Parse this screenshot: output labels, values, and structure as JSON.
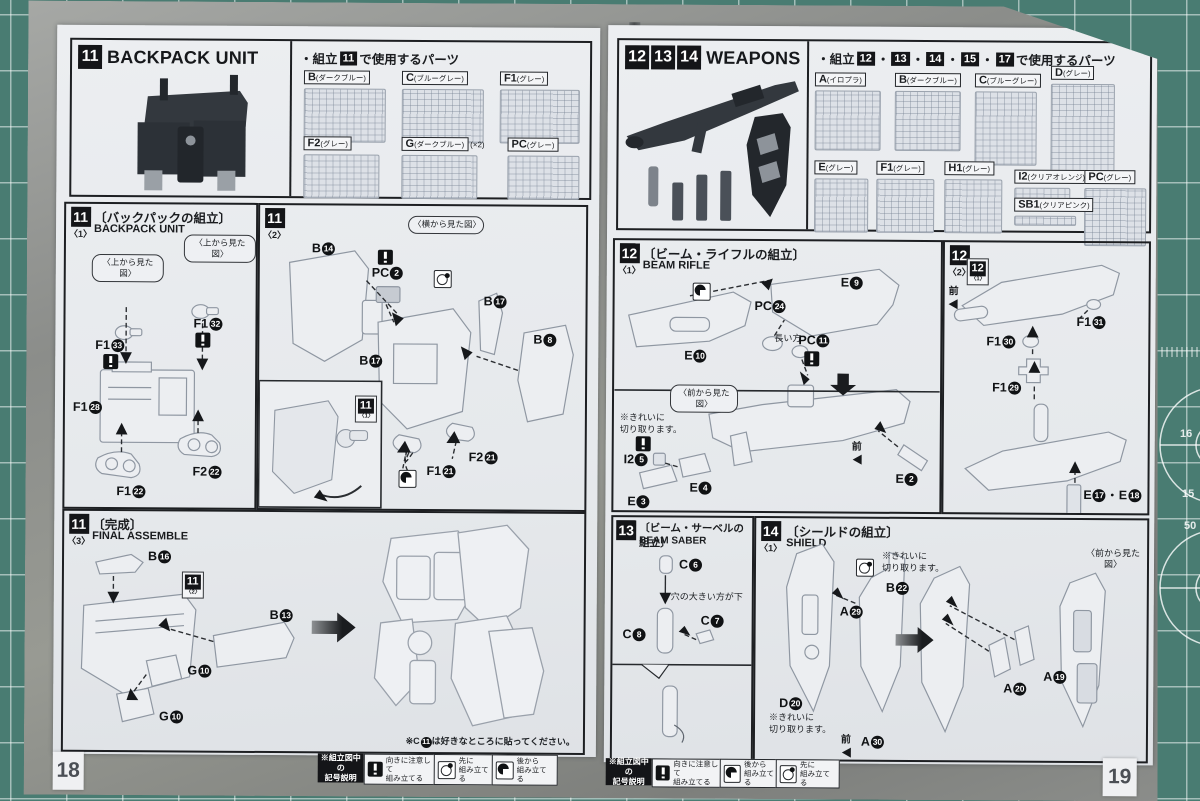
{
  "mat": {
    "ruler_numbers": [
      "16",
      "15",
      "50"
    ]
  },
  "left_page": {
    "page_number": "18",
    "header": {
      "badge": "11",
      "title": "BACKPACK UNIT"
    },
    "parts_panel": {
      "prefix": "・組立",
      "badge": "11",
      "suffix": "で使用するパーツ",
      "runners": [
        {
          "code": "B",
          "color": "(ダークブルー)",
          "qty": ""
        },
        {
          "code": "C",
          "color": "(ブルーグレー)",
          "qty": ""
        },
        {
          "code": "F1",
          "color": "(グレー)",
          "qty": ""
        },
        {
          "code": "F2",
          "color": "(グレー)",
          "qty": ""
        },
        {
          "code": "G",
          "color": "(ダークブルー)",
          "qty": "(×2)"
        },
        {
          "code": "PC",
          "color": "(グレー)",
          "qty": ""
        }
      ]
    },
    "sec1": {
      "badge": "11",
      "step": "〈1〉",
      "title_jp": "〔バックパックの組立〕",
      "title_en": "BACKPACK UNIT",
      "callout1": "〈上から見た図〉",
      "callout2": "〈上から見た図〉",
      "parts": [
        {
          "c": "F1",
          "n": "33"
        },
        {
          "c": "F1",
          "n": "32"
        },
        {
          "c": "F1",
          "n": "28"
        },
        {
          "c": "F1",
          "n": "22"
        },
        {
          "c": "F2",
          "n": "22"
        }
      ]
    },
    "sec2": {
      "badge": "11",
      "step": "〈2〉",
      "callout": "〈横から見た図〉",
      "parts": [
        {
          "c": "B",
          "n": "14"
        },
        {
          "c": "PC",
          "n": "2"
        },
        {
          "c": "B",
          "n": "17"
        },
        {
          "c": "B",
          "n": "17"
        },
        {
          "c": "B",
          "n": "8"
        },
        {
          "c": "F1",
          "n": "21"
        },
        {
          "c": "F2",
          "n": "21"
        }
      ],
      "ref": {
        "badge": "11",
        "step": "〈1〉"
      }
    },
    "sec3": {
      "badge": "11",
      "step": "〈3〉",
      "title_jp": "〔完成〕",
      "title_en": "FINAL ASSEMBLE",
      "parts": [
        {
          "c": "B",
          "n": "16"
        },
        {
          "c": "B",
          "n": "13"
        },
        {
          "c": "G",
          "n": "10"
        },
        {
          "c": "G",
          "n": "10"
        }
      ],
      "ref": {
        "badge": "11",
        "step": "〈2〉"
      },
      "note_pre": "※C",
      "note_num": "11",
      "note_post": "は好きなところに貼ってください。"
    },
    "legend": {
      "label": "※組立図中の\n記号説明",
      "items": [
        {
          "icon": "warning-icon",
          "text": "向きに注意して\n組み立てる"
        },
        {
          "icon": "assemble-first-icon",
          "text": "先に\n組み立てる"
        },
        {
          "icon": "assemble-after-icon",
          "text": "後から\n組み立てる"
        }
      ]
    }
  },
  "right_page": {
    "page_number": "19",
    "header": {
      "badges": [
        "12",
        "13",
        "14"
      ],
      "title": "WEAPONS"
    },
    "parts_panel": {
      "prefix": "・組立",
      "badges": [
        "12",
        "13",
        "14",
        "15",
        "17"
      ],
      "sep": "・",
      "suffix": "で使用するパーツ",
      "runners": [
        {
          "code": "A",
          "color": "(イロプラ)"
        },
        {
          "code": "B",
          "color": "(ダークブルー)"
        },
        {
          "code": "C",
          "color": "(ブルーグレー)"
        },
        {
          "code": "D",
          "color": "(グレー)"
        },
        {
          "code": "E",
          "color": "(グレー)"
        },
        {
          "code": "F1",
          "color": "(グレー)"
        },
        {
          "code": "H1",
          "color": "(グレー)"
        },
        {
          "code": "I2",
          "color": "(クリアオレンジ)"
        },
        {
          "code": "PC",
          "color": "(グレー)"
        },
        {
          "code": "SB1",
          "color": "(クリアピンク)"
        }
      ]
    },
    "sec12_1": {
      "badge": "12",
      "step": "〈1〉",
      "title_jp": "〔ビーム・ライフルの組立〕",
      "title_en": "BEAM RIFLE",
      "labels": [
        {
          "c": "E",
          "n": "9"
        },
        {
          "c": "PC",
          "n": "24"
        },
        {
          "c": "PC",
          "n": "11"
        },
        {
          "c": "E",
          "n": "10"
        },
        {
          "c": "I2",
          "n": "5"
        },
        {
          "c": "E",
          "n": "4"
        },
        {
          "c": "E",
          "n": "3"
        },
        {
          "c": "E",
          "n": "2"
        }
      ],
      "hint_long": "長い方",
      "callout": "〈前から見た図〉",
      "cut_note": "※きれいに\n切り取ります。",
      "front": "前"
    },
    "sec12_2": {
      "badge": "12",
      "step": "〈2〉",
      "front": "前",
      "ref": {
        "badge": "12",
        "step": "〈1〉"
      },
      "labels": [
        {
          "c": "F1",
          "n": "31"
        },
        {
          "c": "F1",
          "n": "30"
        },
        {
          "c": "F1",
          "n": "29"
        }
      ],
      "pair": {
        "c1": "E",
        "n1": "17",
        "dot": "・",
        "c2": "E",
        "n2": "18"
      }
    },
    "sec13": {
      "badge": "13",
      "title_jp": "〔ビーム・サーベルの組立〕",
      "title_en": "BEAM SABER",
      "labels": [
        {
          "c": "C",
          "n": "6"
        },
        {
          "c": "C",
          "n": "8"
        },
        {
          "c": "C",
          "n": "7"
        }
      ],
      "hint": "穴の大きい方が下"
    },
    "sec14": {
      "badge": "14",
      "step": "〈1〉",
      "title_jp": "〔シールドの組立〕",
      "title_en": "SHIELD",
      "cut_note1": "※きれいに\n切り取ります。",
      "cut_note2": "※きれいに\n切り取ります。",
      "front": "前",
      "callout": "〈前から見た図〉",
      "labels": [
        {
          "c": "B",
          "n": "22"
        },
        {
          "c": "A",
          "n": "29"
        },
        {
          "c": "D",
          "n": "20"
        },
        {
          "c": "A",
          "n": "30"
        },
        {
          "c": "A",
          "n": "20"
        },
        {
          "c": "A",
          "n": "19"
        }
      ]
    },
    "legend": {
      "label": "※組立図中の\n記号説明",
      "items": [
        {
          "icon": "warning-icon",
          "text": "向きに注意して\n組み立てる"
        },
        {
          "icon": "assemble-after-icon",
          "text": "後から\n組み立てる"
        },
        {
          "icon": "assemble-first-icon",
          "text": "先に\n組み立てる"
        }
      ]
    }
  }
}
